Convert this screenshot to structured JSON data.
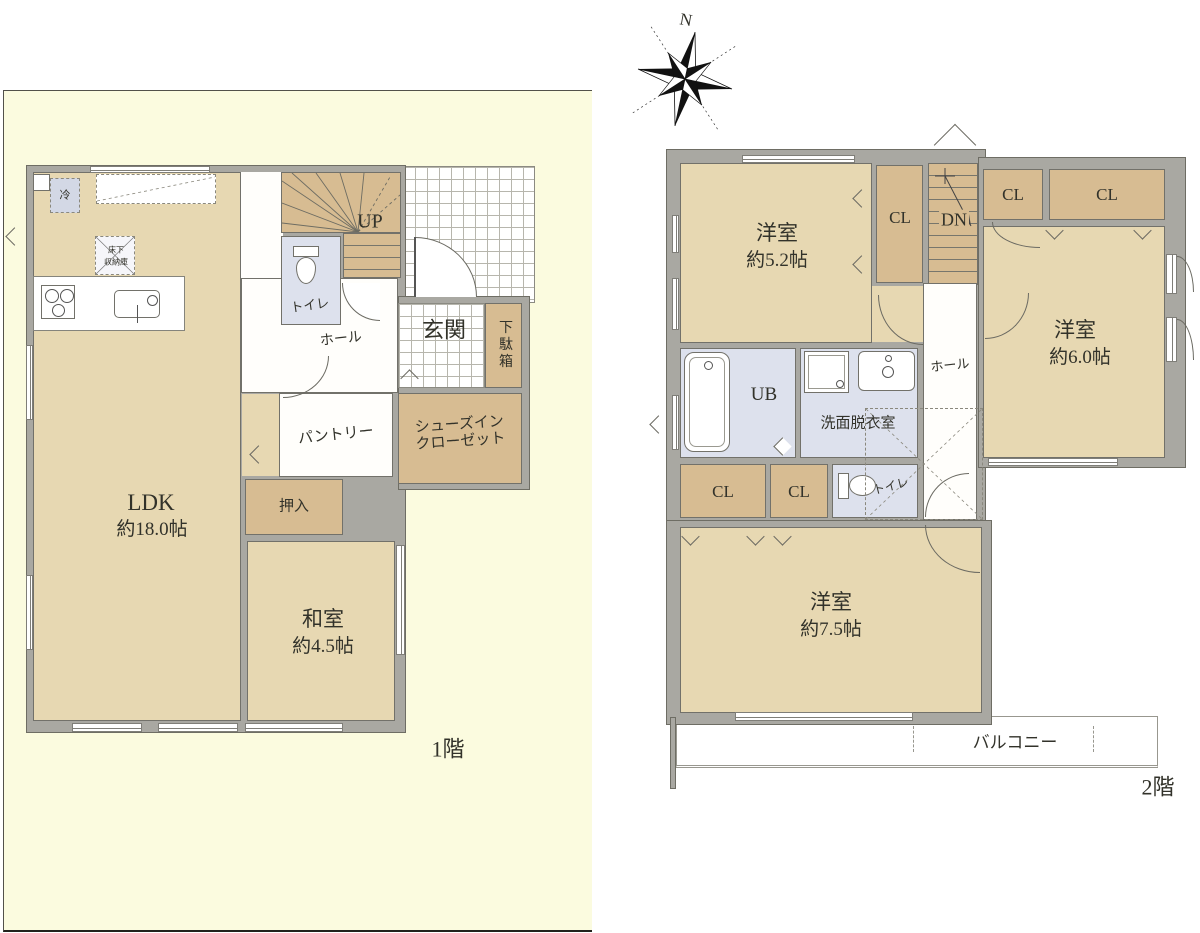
{
  "colors": {
    "panel_yellow": "#fbfbdf",
    "wall_gray": "#a9a8a2",
    "room_beige": "#e7d8b2",
    "closet_tan": "#d7bc92",
    "wet_area_blue": "#dde1ed",
    "text": "#32322a"
  },
  "compass": {
    "north_label": "N"
  },
  "floor1": {
    "caption": "1階",
    "ldk": {
      "name": "LDK",
      "size": "約18.0帖"
    },
    "washitsu": {
      "name": "和室",
      "size": "約4.5帖"
    },
    "oshiire_label": "押入",
    "pantry_label": "パントリー",
    "shoes_in_closet_line1": "シューズイン",
    "shoes_in_closet_line2": "クローゼット",
    "genkan_label": "玄関",
    "getabako_label": "下駄箱",
    "hall_label": "ホール",
    "toilet_label": "トイレ",
    "stairs_label": "UP",
    "fridge_label": "冷",
    "floor_storage_line1": "床下",
    "floor_storage_line2": "収納庫"
  },
  "floor2": {
    "caption": "2階",
    "bedroom_small": {
      "name": "洋室",
      "size": "約5.2帖"
    },
    "bedroom_mid": {
      "name": "洋室",
      "size": "約6.0帖"
    },
    "bedroom_large": {
      "name": "洋室",
      "size": "約7.5帖"
    },
    "closet_label": "CL",
    "stairs_label": "DN",
    "unit_bath_label": "UB",
    "washroom_label": "洗面脱衣室",
    "hall_label": "ホール",
    "toilet_label": "トイレ",
    "balcony_label": "バルコニー"
  }
}
